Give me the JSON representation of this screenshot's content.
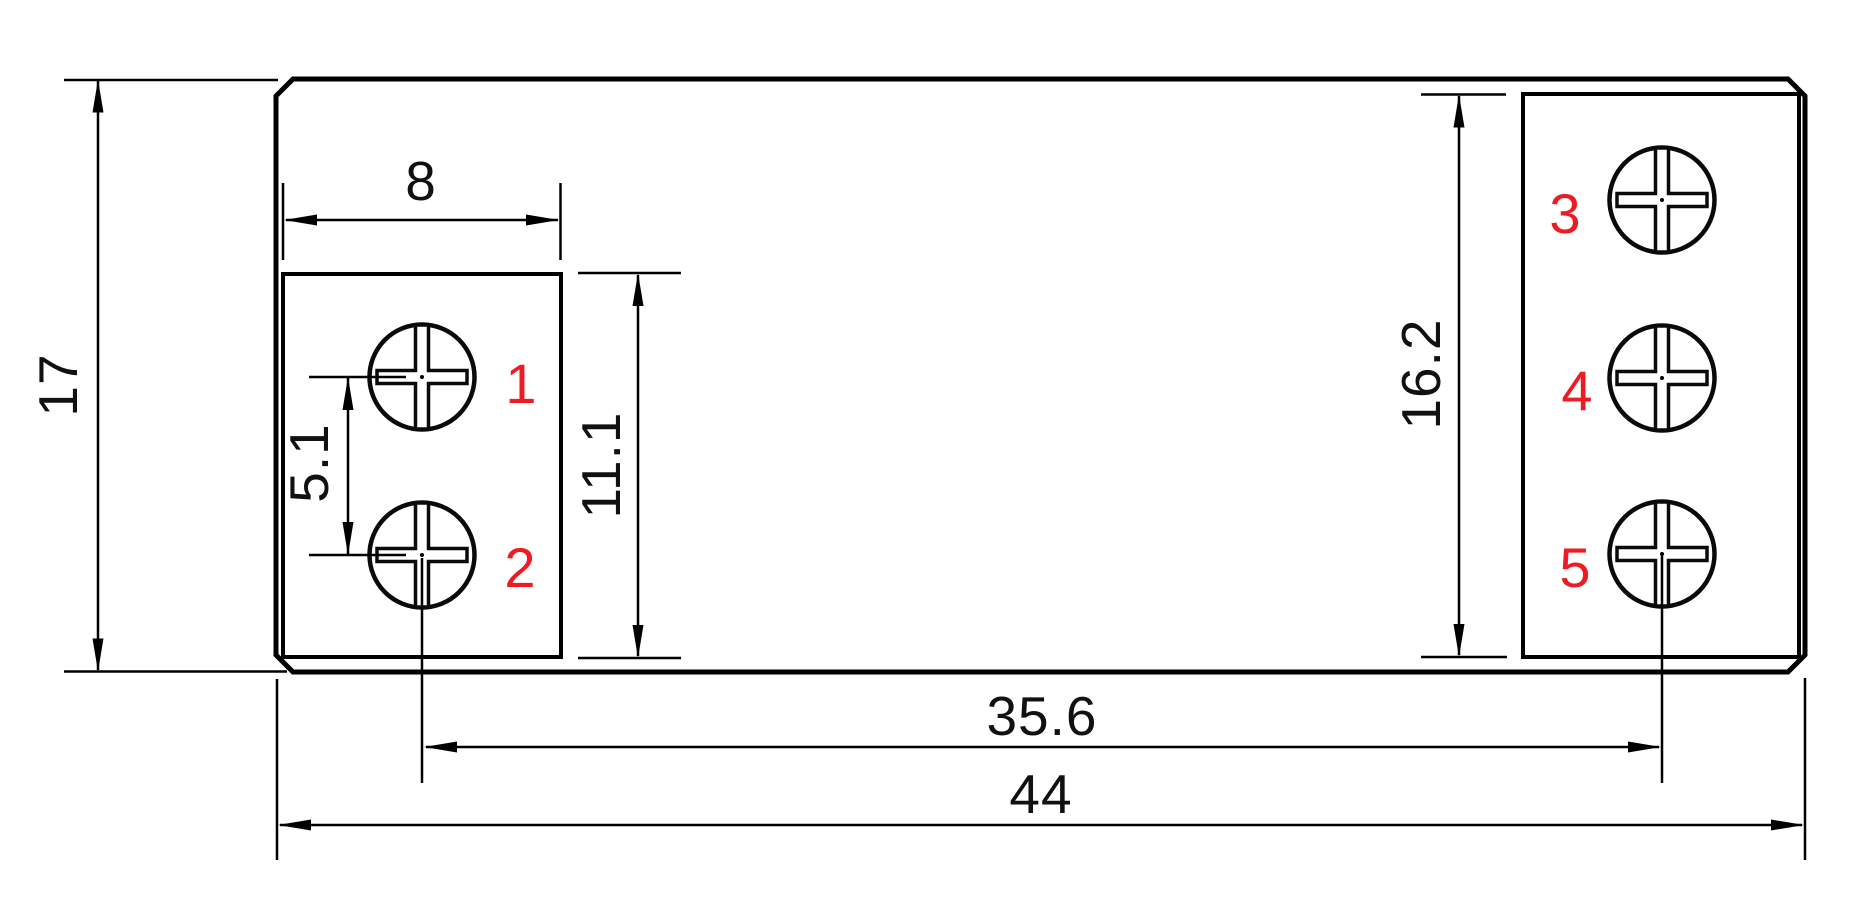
{
  "colors": {
    "line": "#000000",
    "terminal_label": "#ee1b23",
    "background": "#ffffff"
  },
  "dimensions": {
    "overall_height": "17",
    "overall_width": "44",
    "screw_center_span": "35.6",
    "left_block_width": "8",
    "screw_pitch": "5.1",
    "left_block_height": "11.1",
    "right_block_height": "16.2"
  },
  "terminal_labels": [
    "1",
    "2",
    "3",
    "4",
    "5"
  ]
}
